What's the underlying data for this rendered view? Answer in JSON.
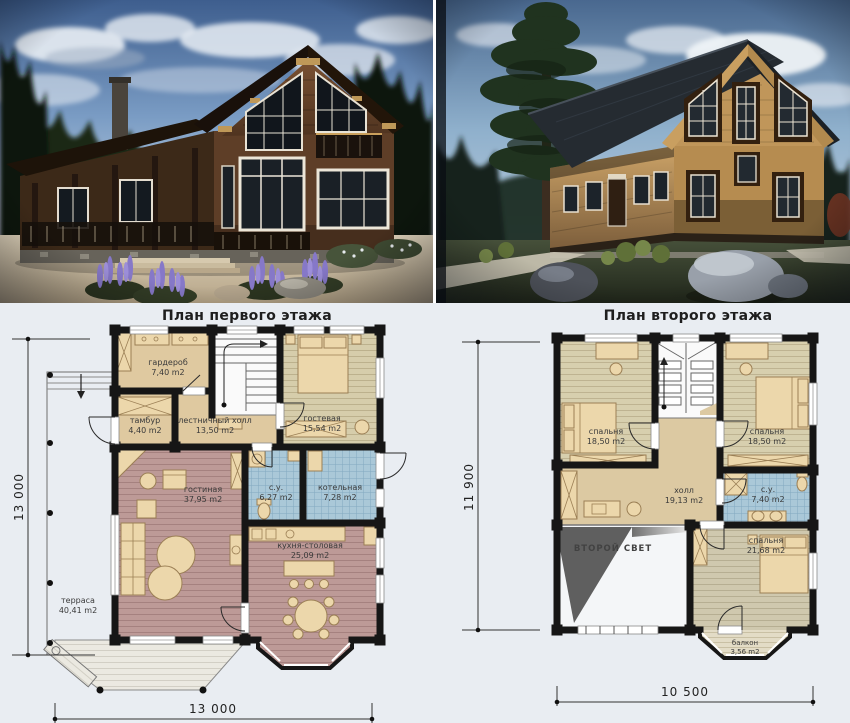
{
  "colors": {
    "background": "#e9edf2",
    "wall": "#161616",
    "floor_tan": "#dfc9a0",
    "floor_olive": "#d6cdab",
    "floor_mauve": "#bd9a97",
    "tile_blue": "#aac8d8",
    "terrace": "#ebe9e1",
    "furniture": "#ecd7ab",
    "void_gray": "#5f5f5f"
  },
  "plans": {
    "first": {
      "title": "План первого этажа",
      "dim_vertical": "13 000",
      "dim_horizontal": "13 000",
      "rooms": [
        {
          "name": "гардероб",
          "area": "7,40 m2"
        },
        {
          "name": "тамбур",
          "area": "4,40 m2"
        },
        {
          "name": "лестничный холл",
          "area": "13,50 m2"
        },
        {
          "name": "гостевая",
          "area": "15,54 m2"
        },
        {
          "name": "гостиная",
          "area": "37,95 m2"
        },
        {
          "name": "с.у.",
          "area": "6,27 m2"
        },
        {
          "name": "котельная",
          "area": "7,28 m2"
        },
        {
          "name": "кухня-столовая",
          "area": "25,09 m2"
        },
        {
          "name": "терраса",
          "area": "40,41 m2"
        }
      ]
    },
    "second": {
      "title": "План второго этажа",
      "dim_vertical": "11 900",
      "dim_horizontal": "10 500",
      "void_label": "ВТОРОЙ СВЕТ",
      "rooms": [
        {
          "name": "спальня",
          "area": "18,50 m2"
        },
        {
          "name": "спальня",
          "area": "18,50 m2"
        },
        {
          "name": "холл",
          "area": "19,13 m2"
        },
        {
          "name": "с.у.",
          "area": "7,40 m2"
        },
        {
          "name": "спальня",
          "area": "21,68 m2"
        },
        {
          "name": "балкон",
          "area": "3,56 m2"
        }
      ]
    }
  }
}
